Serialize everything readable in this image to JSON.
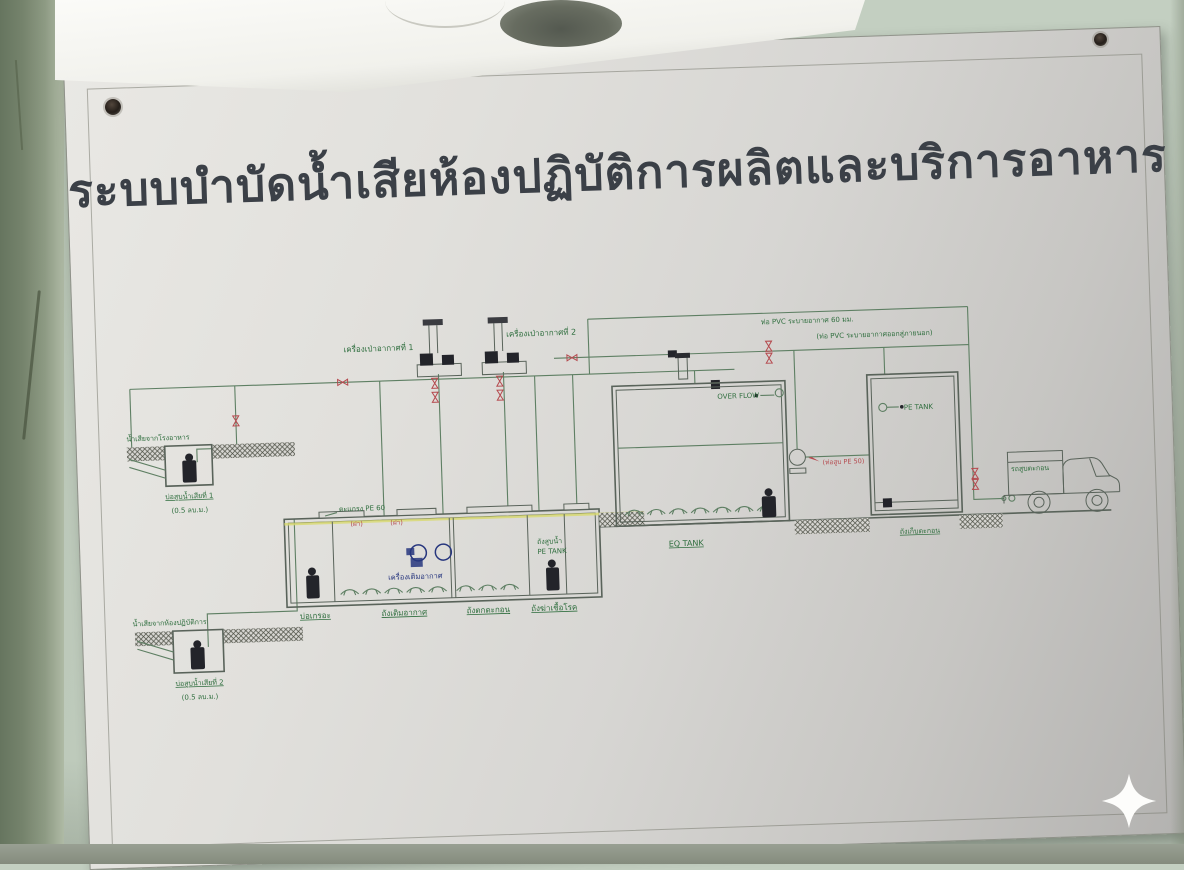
{
  "scene": {
    "title": "ระบบบำบัดน้ำเสียห้องปฏิบัติการผลิตและบริการอาหาร",
    "colors": {
      "wall": "#c3cfc1",
      "board": "#dcdbd7",
      "title_ink": "#3b4047",
      "diagram_green": "#5e7f63",
      "label_green": "#2f6e3e",
      "valve_red": "#b5494e",
      "handnote_blue": "#27367e",
      "water_level_yellow": "#d8d96e"
    },
    "watermark_icon": "sparkle-icon"
  },
  "labels": {
    "blower1": "เครื่องเป่าอากาศที่ 1",
    "blower2": "เครื่องเป่าอากาศที่ 2",
    "vent_note1": "ท่อ PVC ระบายอากาศ 60 มม.",
    "vent_note2": "(ท่อ PVC ระบายอากาศออกสู่ภายนอก)",
    "pit1_source": "น้ำเสียจากโรงอาหาร",
    "pit1_name": "บ่อสูบน้ำเสียที่ 1",
    "pit1_volume": "(0.5 ลบ.ม.)",
    "pit2_source": "น้ำเสียจากห้องปฏิบัติการ",
    "pit2_name": "บ่อสูบน้ำเสียที่ 2",
    "pit2_volume": "(0.5 ลบ.ม.)",
    "screen_note": "ตะแกรง PE 60",
    "cover_tag1": "(ฝา)",
    "cover_tag2": "(ฝา)",
    "comp1": "บ่อเกรอะ",
    "comp2": "ถังเติมอากาศ",
    "comp3": "ถังตกตะกอน",
    "comp4": "ถังฆ่าเชื้อโรค",
    "aerator_blue": "เครื่องเติมอากาศ",
    "clearwell_line1": "ถังสูบน้ำ",
    "clearwell_line2": "PE TANK",
    "tank1_inner": "OVER FLOW",
    "tank1_name": "EQ TANK",
    "pump_note": "(ท่อสูบ PE 50)",
    "tank2_inner": "PE TANK",
    "tank2_name": "ถังเก็บตะกอน",
    "truck_text": "รถสูบตะกอน"
  }
}
